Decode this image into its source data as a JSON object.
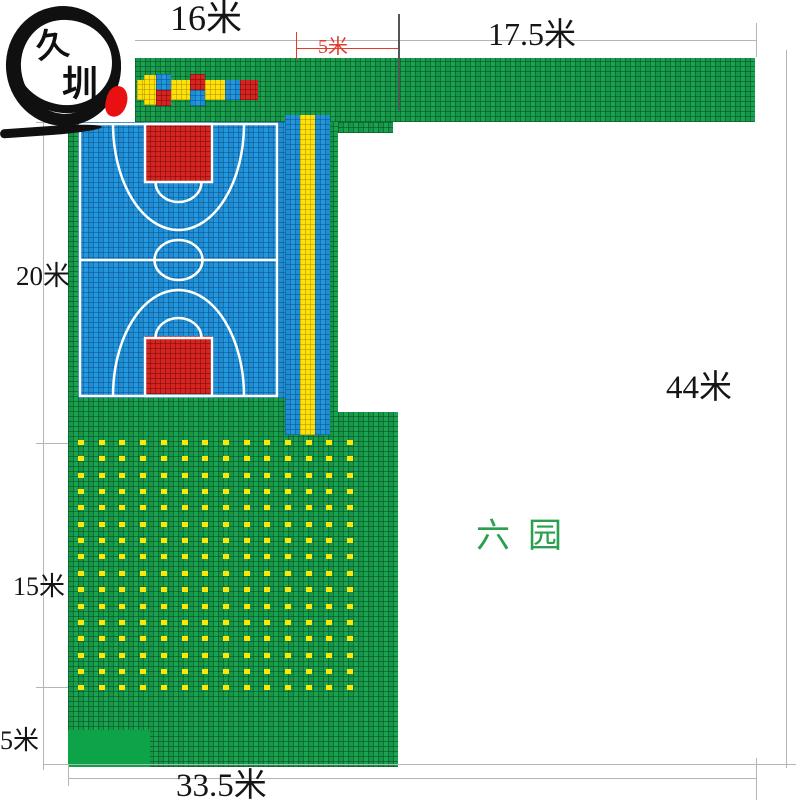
{
  "title": "运动场地铺装平面图",
  "logo": {
    "char_top": "久",
    "char_bottom": "圳"
  },
  "labels": {
    "top_width": "16米",
    "top_right_width": "17.5米",
    "gap_width_red": "5米",
    "court_height": "20米",
    "total_height": "44米",
    "mid_height": "15米",
    "bottom_left_height": "5米",
    "bottom_width": "33.5米",
    "area_name": "六园"
  },
  "colors": {
    "green": "#1ca351",
    "solid_green": "#0da348",
    "blue": "#2398de",
    "red": "#d62420",
    "yellow": "#ffe10a",
    "dot": "#ffe604",
    "dim_red": "#e23b2e",
    "area_text": "#2aa04f",
    "line_gray": "#b4b4b4",
    "seal_red": "#e81010",
    "court_line": "#ffffff"
  },
  "deco_blocks": [
    {
      "x": 137,
      "y": 80,
      "w": 7,
      "h": 20,
      "c": "yellow"
    },
    {
      "x": 144,
      "y": 75,
      "w": 12,
      "h": 30,
      "c": "yellow"
    },
    {
      "x": 156,
      "y": 74,
      "w": 15,
      "h": 16,
      "c": "blue"
    },
    {
      "x": 156,
      "y": 90,
      "w": 15,
      "h": 16,
      "c": "red"
    },
    {
      "x": 171,
      "y": 80,
      "w": 19,
      "h": 20,
      "c": "yellow"
    },
    {
      "x": 190,
      "y": 74,
      "w": 15,
      "h": 16,
      "c": "red"
    },
    {
      "x": 190,
      "y": 90,
      "w": 15,
      "h": 16,
      "c": "blue"
    },
    {
      "x": 205,
      "y": 80,
      "w": 20,
      "h": 20,
      "c": "yellow"
    },
    {
      "x": 225,
      "y": 80,
      "w": 15,
      "h": 20,
      "c": "blue"
    },
    {
      "x": 240,
      "y": 80,
      "w": 18,
      "h": 20,
      "c": "red"
    }
  ],
  "dots_grid": {
    "start_x": 78,
    "step_x": 20.7,
    "cols": 14,
    "start_y": 440,
    "step_y": 16.35,
    "rows": 16
  }
}
